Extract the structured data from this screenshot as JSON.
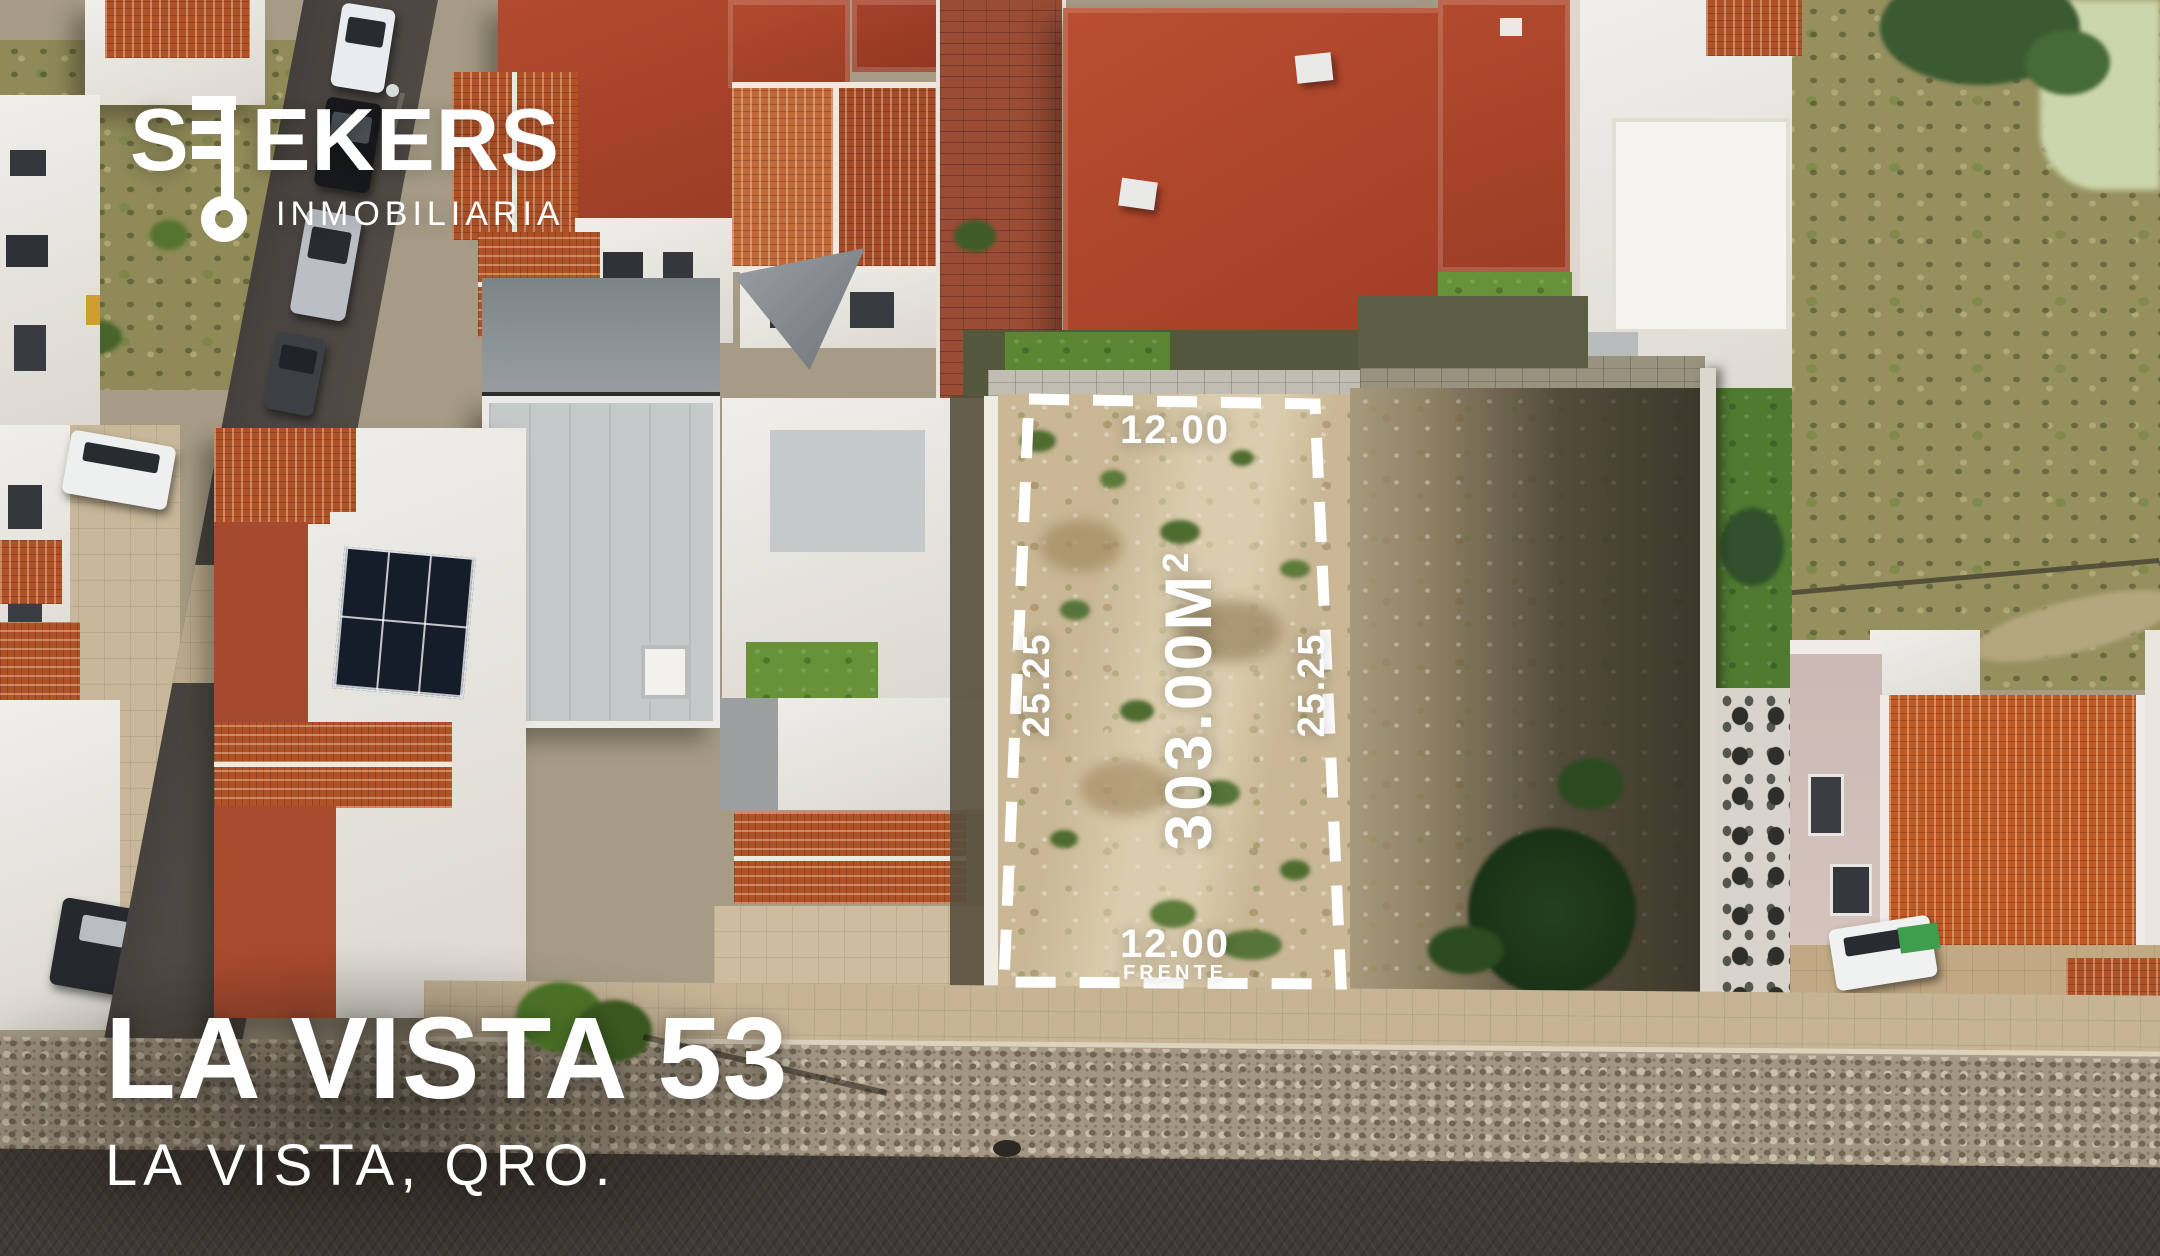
{
  "brand": {
    "name": "SEEKERS",
    "display_prefix": "S",
    "display_suffix": "EKERS",
    "tagline": "INMOBILIARIA",
    "icon": "key-icon",
    "color": "#ffffff"
  },
  "lot": {
    "area_value": "303.00M",
    "area_superscript": "2",
    "width_top": "12.00",
    "width_bottom": "12.00",
    "width_bottom_caption": "FRENTE",
    "depth_left": "25.25",
    "depth_right": "25.25",
    "outline_color": "#ffffff"
  },
  "listing": {
    "title": "LA VISTA 53",
    "location": "LA VISTA, QRO."
  },
  "scene": {
    "description": "Aerial drone photo of a residential street; vacant dirt lot outlined with white dashed boundary between finished homes",
    "palette": {
      "dirt_lot": "#c9b795",
      "dirt_shaded": "#6e6550",
      "tile_roof": "#b05228",
      "flat_roof_red": "#a8422b",
      "white_wall": "#e9e7e2",
      "asphalt_road": "#3f3a35",
      "lawn_green": "#679238",
      "scrub_field": "#96905f",
      "pebble_sidewalk": "#a39683",
      "paver_tan": "#c6b495"
    }
  }
}
